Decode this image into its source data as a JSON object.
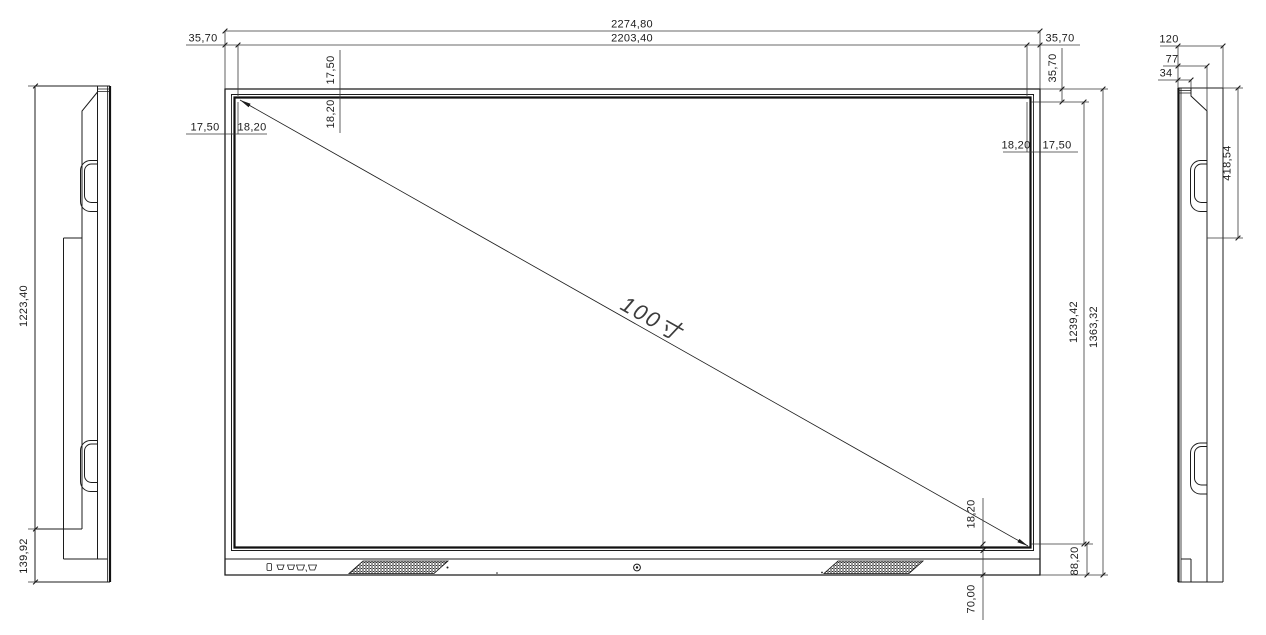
{
  "page": {
    "background": "#ffffff",
    "line_color": "#1c1c1c"
  },
  "front_view": {
    "dim_overall_width": "2274,80",
    "dim_active_width": "2203,40",
    "dim_bezel_left": "35,70",
    "dim_bezel_right": "35,70",
    "dim_bezel_top": "35,70",
    "dim_top_outer_inset": "17,50",
    "dim_top_inner_inset": "18,20",
    "dim_left_outer_inset": "17,50",
    "dim_left_inner_inset": "18,20",
    "dim_right_inner_inset": "18,20",
    "dim_right_outer_inset": "17,50",
    "dim_bottom_inner_inset": "18,20",
    "dim_bottom_glass_offset": "70,00",
    "dim_bottom_bezel": "88,20",
    "dim_active_height": "1239,42",
    "dim_overall_height": "1363,32",
    "diagonal_label": "100寸"
  },
  "left_view": {
    "dim_body_height": "1223,40",
    "dim_base_height": "139,92"
  },
  "right_view": {
    "dim_depth_overall": "120",
    "dim_depth_mid": "77",
    "dim_depth_front": "34",
    "dim_handle_offset": "418,54"
  }
}
